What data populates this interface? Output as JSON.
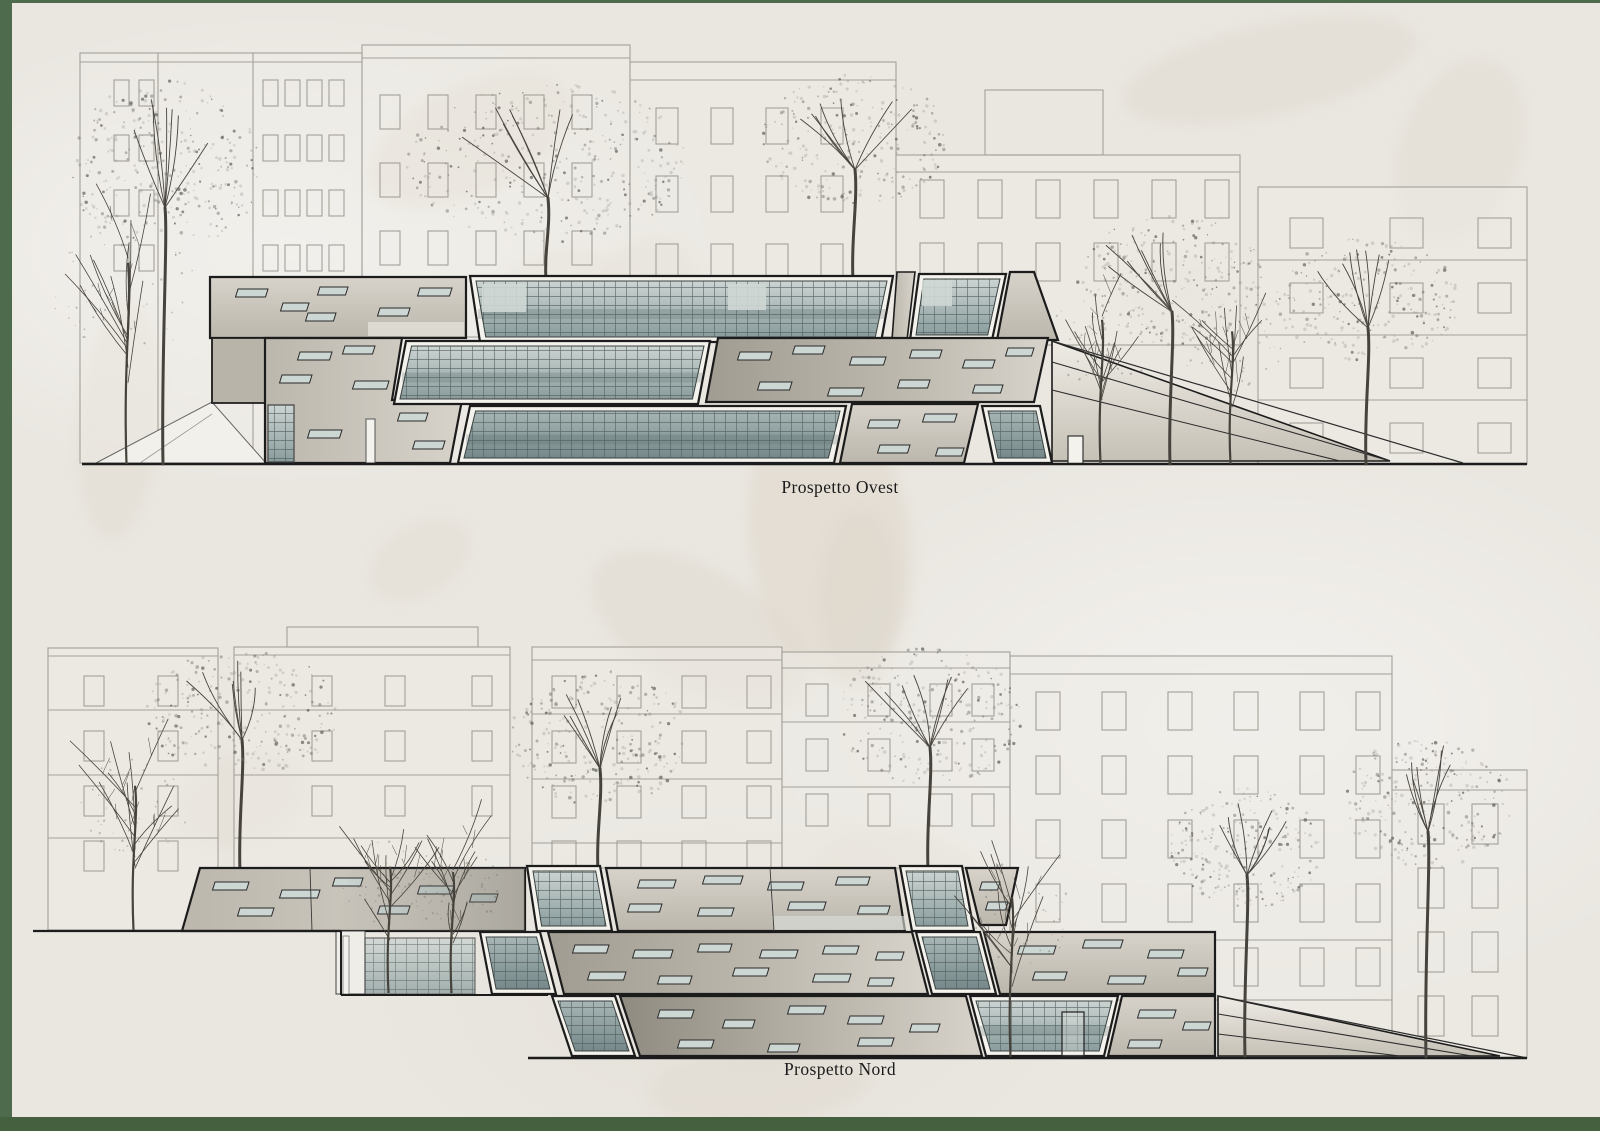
{
  "board": {
    "background_color": "#eae7e1",
    "frame_color": "#4e6b4d",
    "frame_sides": [
      "left",
      "top",
      "bottom"
    ]
  },
  "elevations": [
    {
      "id": "ovest",
      "label": "Prospetto Ovest"
    },
    {
      "id": "nord",
      "label": "Prospetto Nord"
    }
  ],
  "palette": {
    "outline": "#1c1c1c",
    "concrete_light": "#d7d3ca",
    "concrete_mid": "#bcb7ad",
    "concrete_dark": "#a19c91",
    "concrete_shadow": "#8f8b81",
    "glass_light": "#ccd4d2",
    "glass_mid": "#a7b6b5",
    "glass_dark": "#8a9c9d",
    "slit_fill": "#ccd6d3",
    "frame_white": "#f4f2ed",
    "bg_building_line": "#a3a099",
    "tree_foliage": "#5f5f5a",
    "tree_trunk": "#46433c",
    "watermark": "#ddd5c8",
    "ground_line": "#1c1c1c"
  }
}
